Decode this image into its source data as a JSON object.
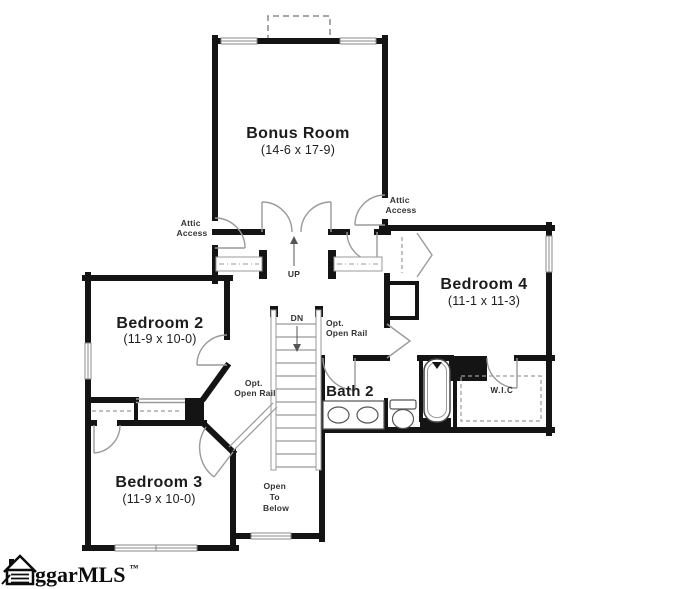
{
  "rooms": {
    "bonus_room": {
      "name": "Bonus Room",
      "dims": "(14-6 x 17-9)"
    },
    "bedroom_2": {
      "name": "Bedroom 2",
      "dims": "(11-9 x 10-0)"
    },
    "bedroom_3": {
      "name": "Bedroom 3",
      "dims": "(11-9 x 10-0)"
    },
    "bedroom_4": {
      "name": "Bedroom 4",
      "dims": "(11-1 x 11-3)"
    },
    "bath_2": {
      "name": "Bath 2"
    },
    "wic": {
      "name": "W.I.C"
    }
  },
  "labels": {
    "attic_access_left": [
      "Attic",
      "Access"
    ],
    "attic_access_right": [
      "Attic",
      "Access"
    ],
    "up": "UP",
    "dn": "DN",
    "opt_open_rail_right": [
      "Opt.",
      "Open Rail"
    ],
    "opt_open_rail_left": [
      "Opt.",
      "Open Rail"
    ],
    "open_to_below": [
      "Open",
      "To",
      "Below"
    ]
  },
  "logo": {
    "text": "ggarMLS",
    "trademark": "™"
  },
  "colors": {
    "wall": "#141414",
    "thin_line": "#9a9a9a",
    "fixture": "#555555",
    "text": "#1c1c1c",
    "background": "#ffffff"
  }
}
